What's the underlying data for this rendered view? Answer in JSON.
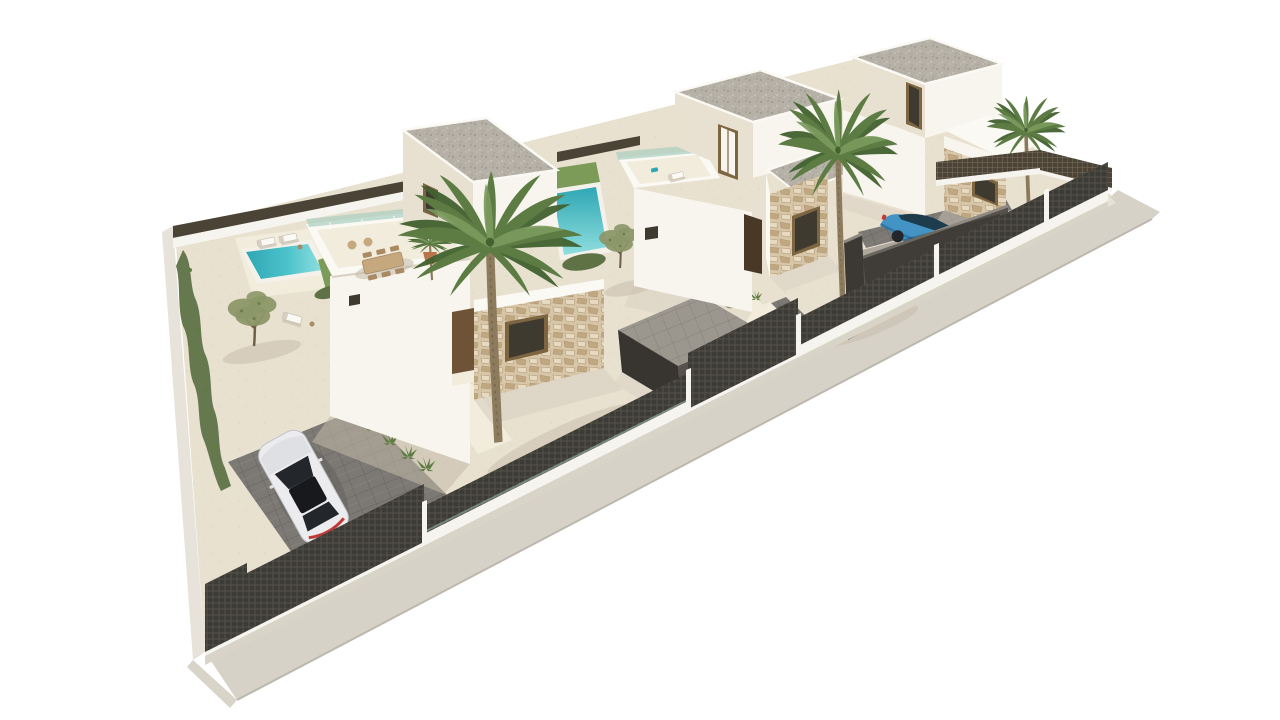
{
  "scene": {
    "description": "Aerial 3D architectural rendering of three modern white flat-roof villas on a diagonal walled plot with private pools, palm trees, olive trees, stone-clad entrance volumes, mesh perimeter fencing, a silver car on a paved driveway and a blue car in a walled carport, all on a plain white background",
    "objects": [
      "perimeter-wall",
      "mesh-fence",
      "sidewalk",
      "sand-garden",
      "villa-left",
      "villa-middle",
      "villa-right",
      "pool-left",
      "pool-middle",
      "lawn-strips",
      "palm-tree-large",
      "palm-tree-middle",
      "palm-tree-right",
      "potted-palm",
      "olive-tree-left",
      "olive-tree-middle",
      "hedge-row",
      "dining-set",
      "sun-loungers",
      "silver-car",
      "blue-car",
      "driveway-pavers",
      "garage-box",
      "carport-walls"
    ]
  },
  "colors": {
    "background": "#ffffff",
    "outer_wall": "#e7e3db",
    "plinth": "#d9d4c8",
    "sidewalk": "#d7d2c7",
    "sidewalk_light": "#e6e2d8",
    "sidewalk_edge": "#bdb8ae",
    "sand": "#e9e1d0",
    "sand_dot": "#d9d0bb",
    "sand_light": "#f2ecdd",
    "lawn": "#7d9b58",
    "lawn_dark": "#5e7d42",
    "hedge": "#5f7246",
    "olive": "#8c9768",
    "olive_dark": "#6b7a4a",
    "pool_deep": "#2fa7b4",
    "pool_mid": "#4cc3cb",
    "pool_light": "#8fdede",
    "pool_rim": "#f4f1ea",
    "wall_bright": "#f8f5ef",
    "wall_shade": "#e8e0d0",
    "parapet_top": "#fbf9f4",
    "glass_green": "#a9cfc0",
    "roof_gravel": "#b6b1a7",
    "roof_speckle_dark": "#968f83",
    "roof_speckle_light": "#d0cabe",
    "stone_base": "#d8c6a8",
    "stone_dark": "#bfa780",
    "stone_light": "#e8dac1",
    "stone_line": "#b09878",
    "door_brown": "#6e5336",
    "door_dark": "#4a3826",
    "window_dark": "#3f3a30",
    "window_frame": "#7d6542",
    "fence_dark": "#3d3b36",
    "fence_line": "#5a564e",
    "fence_brown": "#4a4336",
    "fence_brown_line": "#6e6253",
    "wall_base_white": "#f6f4ee",
    "paver": "#7c7974",
    "paver_line": "#65625d",
    "paver_light": "#9b978e",
    "paver_light_line": "#86827a",
    "dark_wall": "#56524b",
    "dark_wall_top": "#8e8a82",
    "shadow": "#d7cfc0",
    "shadow_dark": "#c3b9a7",
    "trunk": "#8d7b5e",
    "trunk_dark": "#6e5f47",
    "palm": "#5c7c44",
    "palm_dark": "#42622f",
    "palm_light": "#7a9a5e",
    "pot": "#b8744a",
    "furniture_tan": "#c6a87f",
    "furniture_brown": "#a98a62",
    "car_silver": "#ececee",
    "car_silver_shade": "#dfe0e3",
    "car_silver_line": "#c2c3c7",
    "car_glass": "#23272c",
    "car_roof": "#17191c",
    "car_red": "#c03a35",
    "car_blue": "#4394c4",
    "car_blue_dark": "#2d77a5",
    "car_blue_glass": "#1d3d4e"
  }
}
